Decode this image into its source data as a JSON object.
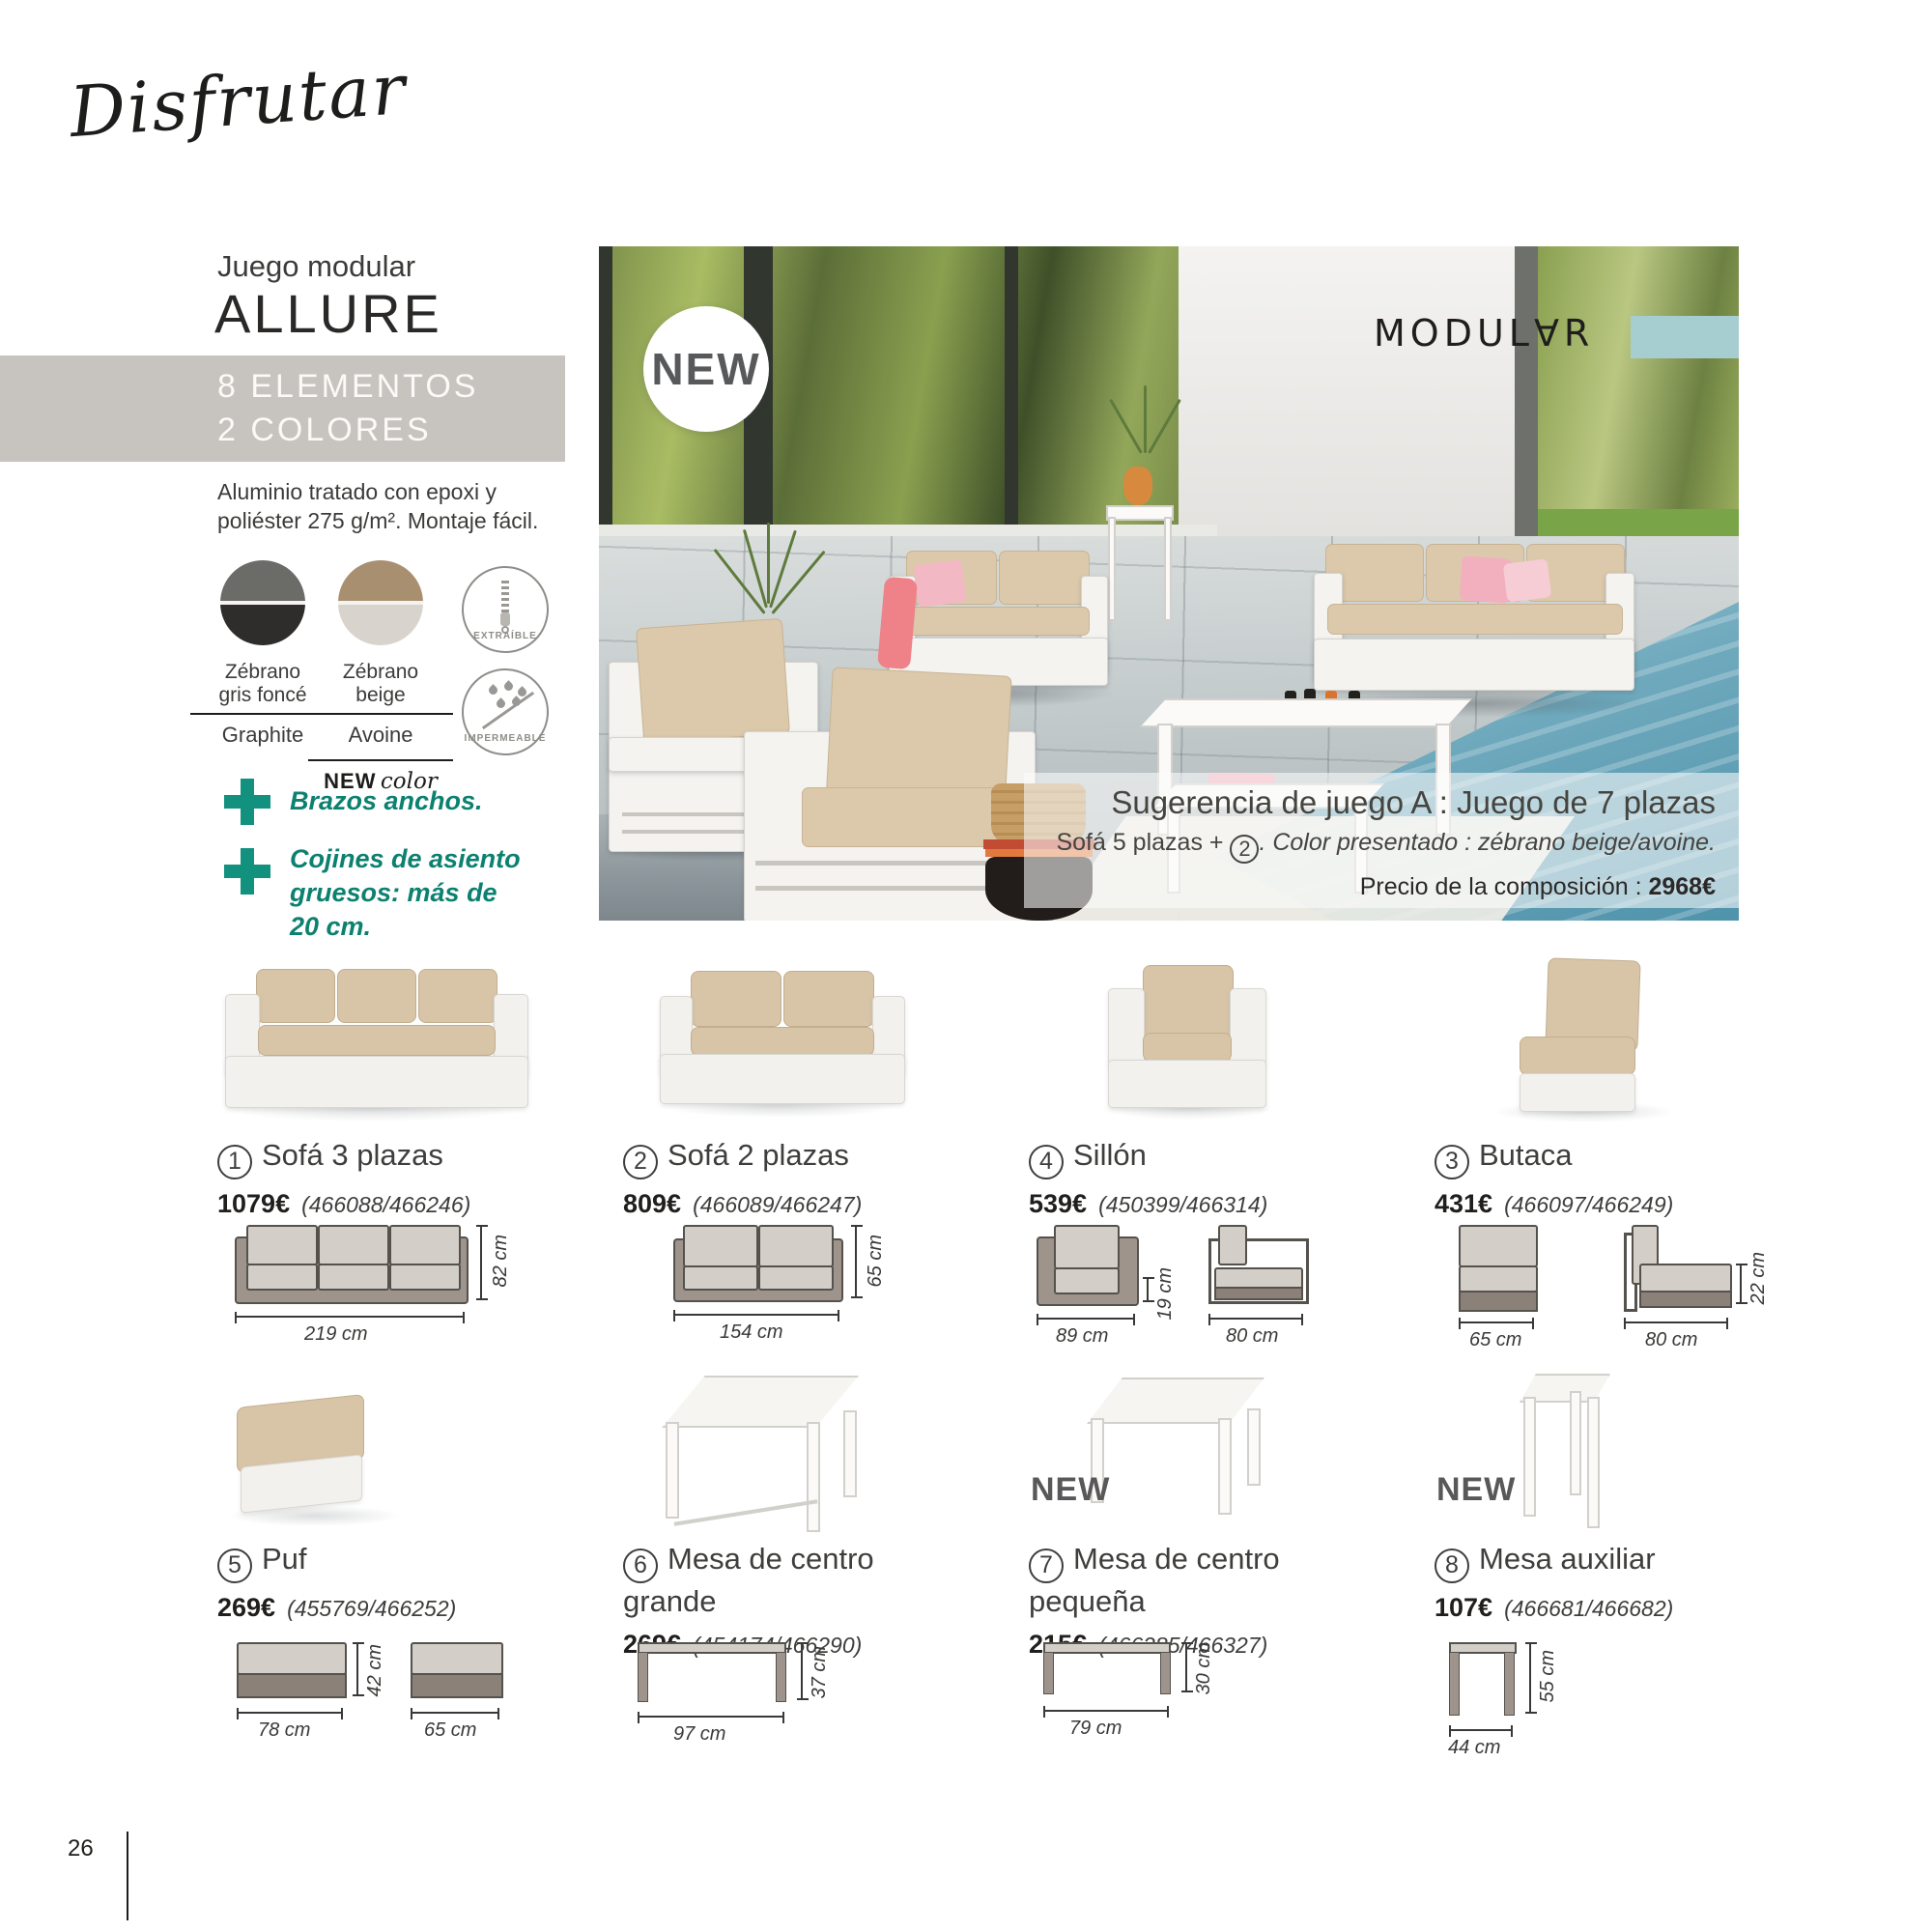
{
  "page": {
    "script_title": "Disfrutar",
    "page_number": "26"
  },
  "intro": {
    "subtitle": "Juego modular",
    "title": "ALLURE",
    "banner_line1": "8 ELEMENTOS",
    "banner_line2": "2 COLORES",
    "description": "Aluminio tratado con epoxi y poliéster 275 g/m². Montaje fácil.",
    "swatches": [
      {
        "line1": "Zébrano",
        "line2": "gris foncé",
        "alt": "Graphite"
      },
      {
        "line1": "Zébrano",
        "line2": "beige",
        "alt": "Avoine",
        "badge_bold": "NEW",
        "badge_script": "color"
      }
    ],
    "feature_badges": [
      {
        "label": "EXTRAÍBLE"
      },
      {
        "label": "IMPERMEABLE"
      }
    ],
    "bullet1": "Brazos anchos.",
    "bullet2": "Cojines de asiento gruesos: más de 20 cm."
  },
  "hero": {
    "new_badge": "NEW",
    "brand": "MODUL∀R",
    "suggestion_title": "Sugerencia de juego A : Juego de 7 plazas",
    "suggestion_pre": "Sofá 5 plazas +",
    "suggestion_circle": "2",
    "suggestion_post": ". Color presentado : zébrano beige/avoine.",
    "price_label": "Precio de la composición : ",
    "price_value": "2968€"
  },
  "colors": {
    "accent_teal": "#12917e",
    "green_text": "#0c8170",
    "band_gray": "#c7c3be",
    "hero_teal_block": "#a6ced1"
  },
  "products": [
    {
      "num": "1",
      "name": "Sofá 3 plazas",
      "price": "1079€",
      "codes": "(466088/466246)",
      "dim_w": "219 cm",
      "dim_h": "82 cm"
    },
    {
      "num": "2",
      "name": "Sofá 2 plazas",
      "price": "809€",
      "codes": "(466089/466247)",
      "dim_w": "154 cm",
      "dim_h": "65 cm"
    },
    {
      "num": "4",
      "name": "Sillón",
      "price": "539€",
      "codes": "(450399/466314)",
      "dim_w": "89 cm",
      "dim_h": "19 cm",
      "dim_d": "80 cm"
    },
    {
      "num": "3",
      "name": "Butaca",
      "price": "431€",
      "codes": "(466097/466249)",
      "dim_w": "65 cm",
      "dim_d": "80 cm",
      "dim_h": "22 cm"
    },
    {
      "num": "5",
      "name": "Puf",
      "price": "269€",
      "codes": "(455769/466252)",
      "dim_w": "78 cm",
      "dim_h": "42 cm",
      "dim_d": "65 cm"
    },
    {
      "num": "6",
      "name": "Mesa de centro grande",
      "price": "269€",
      "codes": "(454174/466290)",
      "dim_w": "97 cm",
      "dim_h": "37 cm"
    },
    {
      "num": "7",
      "name": "Mesa de centro pequeña",
      "price": "215€",
      "codes": "(466285/466327)",
      "dim_w": "79 cm",
      "dim_h": "30 cm",
      "new_label": "NEW"
    },
    {
      "num": "8",
      "name": "Mesa auxiliar",
      "price": "107€",
      "codes": "(466681/466682)",
      "dim_w": "44 cm",
      "dim_h": "55 cm",
      "new_label": "NEW"
    }
  ]
}
